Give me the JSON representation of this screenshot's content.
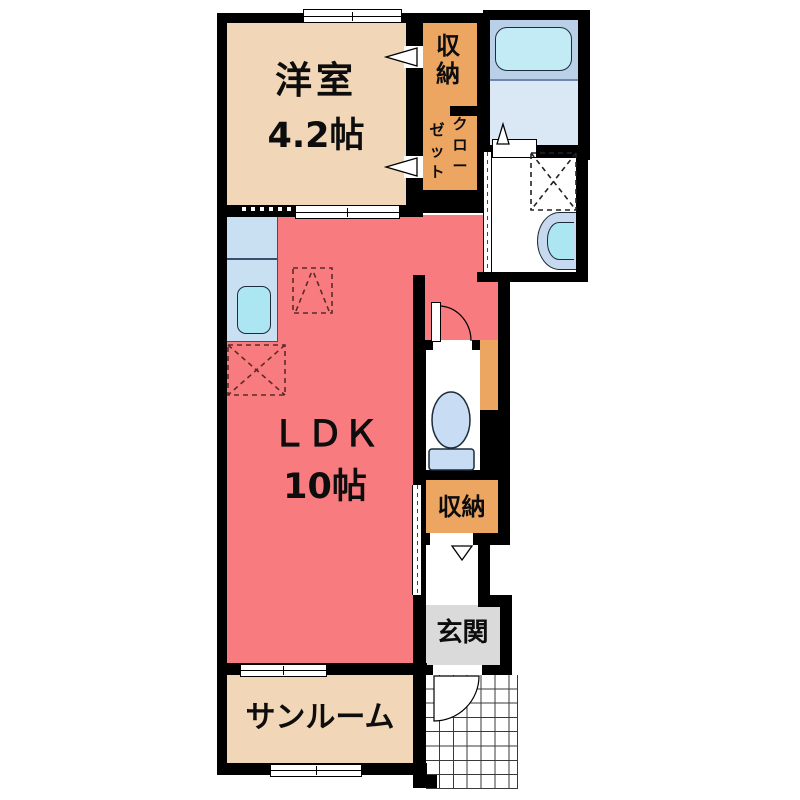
{
  "rooms": {
    "western": {
      "label": "洋室",
      "size": "4.2帖"
    },
    "storage_top": {
      "label": "収\n納"
    },
    "closet": {
      "label_right": "ク\nロ\nー",
      "label_left": "ゼ\nッ\nト"
    },
    "ldk": {
      "label": "ＬＤＫ",
      "size": "10帖"
    },
    "storage_mid": {
      "label": "収納"
    },
    "entrance": {
      "label": "玄関"
    },
    "sunroom": {
      "label": "サンルーム"
    }
  },
  "colors": {
    "wall": "#000000",
    "room_beige": "#F2D6B8",
    "storage_orange": "#ECA662",
    "ldk_salmon": "#F87C7F",
    "entrance_gray": "#DADADA",
    "bath_upper_blue": "#BACFE8",
    "bath_lower_blue": "#DAE8F6",
    "bathtub_cyan": "#C3EBF5",
    "kitchen_counter_blue": "#C9DFF2",
    "sink_cyan": "#ABE6F2",
    "fixture_blue": "#C8DCF4",
    "dashed_marker": "#5a2a2a"
  }
}
